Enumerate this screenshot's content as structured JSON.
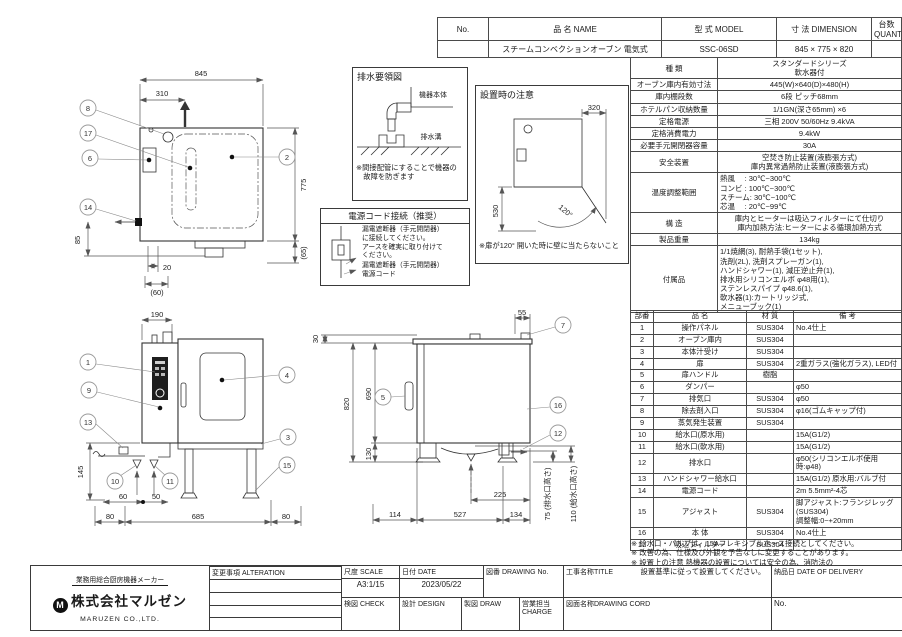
{
  "header_table": {
    "cols": {
      "no": "No.",
      "name": "品  名  NAME",
      "model": "型  式  MODEL",
      "dimension": "寸  法  DIMENSION",
      "quantity": "台数 QUANTITY"
    },
    "row": {
      "no": "",
      "name": "スチームコンベクションオーブン 電気式",
      "model": "SSC-06SD",
      "dimension": "845 × 775 × 820",
      "quantity": ""
    }
  },
  "spec_table": {
    "rows": [
      {
        "label": "種  類",
        "value": "スタンダードシリーズ\n軟水器付"
      },
      {
        "label": "オーブン庫内有効寸法",
        "value": "445(W)×640(D)×480(H)"
      },
      {
        "label": "庫内棚段数",
        "value": "6段 ピッチ68mm"
      },
      {
        "label": "ホテルパン収納数量",
        "value": "1/1GN(深さ65mm) ×6"
      },
      {
        "label": "定格電源",
        "value": "三相 200V 50/60Hz 9.4kVA"
      },
      {
        "label": "定格消費電力",
        "value": "9.4kW"
      },
      {
        "label": "必要手元開閉器容量",
        "value": "30A"
      },
      {
        "label": "安全装置",
        "value": "空焚き防止装置(液膨張方式)\n庫内異常過熱防止装置(液膨張方式)"
      },
      {
        "label": "温度調整範囲",
        "value": "熱風　 : 30℃~300℃\nコンビ : 100℃~300℃\nスチーム: 30℃~100℃\n芯温　 : 20℃~99℃"
      },
      {
        "label": "構  造",
        "value": "庫内とヒーターは吸込フィルターにて仕切り\n庫内加熱方法:ヒーターによる循環加熱方式"
      },
      {
        "label": "製品重量",
        "value": "134kg"
      },
      {
        "label": "付属品",
        "value": "1/1焼網(3), 耐熱手袋(1セット),\n洗剤(2L), 洗剤スプレーガン(1),\nハンドシャワー(1), 減圧逆止弁(1),\n排水用シリコンエルボ φ48用(1),\nステンレスパイプ φ48.6(1),\n軟水器(1):カートリッジ式,\nメニューブック(1)"
      }
    ]
  },
  "parts_table": {
    "headers": {
      "no": "部番",
      "name": "品  名",
      "material": "材  質",
      "remarks": "備  考"
    },
    "rows": [
      {
        "no": "1",
        "name": "操作パネル",
        "material": "SUS304",
        "remarks": "No.4仕上"
      },
      {
        "no": "2",
        "name": "オーブン庫内",
        "material": "SUS304",
        "remarks": ""
      },
      {
        "no": "3",
        "name": "本体汁受け",
        "material": "SUS304",
        "remarks": ""
      },
      {
        "no": "4",
        "name": "扉",
        "material": "SUS304",
        "remarks": "2重ガラス(強化ガラス), LED付"
      },
      {
        "no": "5",
        "name": "扉ハンドル",
        "material": "樹脂",
        "remarks": ""
      },
      {
        "no": "6",
        "name": "ダンパー",
        "material": "",
        "remarks": "φ50"
      },
      {
        "no": "7",
        "name": "排気口",
        "material": "SUS304",
        "remarks": "φ50"
      },
      {
        "no": "8",
        "name": "除去剤入口",
        "material": "SUS304",
        "remarks": "φ16(ゴムキャップ付)"
      },
      {
        "no": "9",
        "name": "蒸気発生装置",
        "material": "SUS304",
        "remarks": ""
      },
      {
        "no": "10",
        "name": "給水口(原水用)",
        "material": "",
        "remarks": "15A(G1/2)"
      },
      {
        "no": "11",
        "name": "給水口(軟水用)",
        "material": "",
        "remarks": "15A(G1/2)"
      },
      {
        "no": "12",
        "name": "排水口",
        "material": "",
        "remarks": "φ50(シリコンエルボ使用時:φ48)"
      },
      {
        "no": "13",
        "name": "ハンドシャワー給水口",
        "material": "",
        "remarks": "15A(G1/2) 原水用:バルブ付"
      },
      {
        "no": "14",
        "name": "電源コード",
        "material": "",
        "remarks": "2m 5.5mm²-4芯"
      },
      {
        "no": "15",
        "name": "アジャスト",
        "material": "SUS304",
        "remarks": "脚アジャスト:フランジレッグ(SUS304)\n調整幅:0~+20mm"
      },
      {
        "no": "16",
        "name": "本  体",
        "material": "SUS304",
        "remarks": "No.4仕上"
      },
      {
        "no": "17",
        "name": "吸込フィルター",
        "material": "SUS304",
        "remarks": ""
      }
    ]
  },
  "notes": "※ 給水口・バルブは、15Aフレキシブルホース接続としてください。\n※ 改善の為、仕様及び外観を予告なしに変更することがあります。\n※ 設置上の注意 熱機器の設置については安全の為、消防法の\n　 設置基準に従って設置してください。",
  "title_block": {
    "maker_tagline": "業務用総合厨房機器メーカー",
    "company": "株式会社マルゼン",
    "company_en": "MARUZEN CO.,LTD.",
    "alteration_label": "変更事項 ALTERATION",
    "scale_label": "尺度 SCALE",
    "scale_value": "A3:1/15",
    "date_label": "日付 DATE",
    "date_value": "2023/05/22",
    "check_label": "検図 CHECK",
    "design_label": "設計 DESIGN",
    "draw_label": "製図 DRAW",
    "drawing_no_label": "図番 DRAWING No.",
    "charge_label": "営業担当CHARGE",
    "title_label": "工事名称TITLE",
    "drawing_name_label": "図面名称DRAWING CORD",
    "delivery_label": "納品日 DATE OF DELIVERY",
    "no_label": "No."
  },
  "boxes": {
    "drain": {
      "title": "排水要領図",
      "body_label": "機器本体",
      "ditch_label": "排水溝",
      "note": "※間接配管にすることで機器の\n　故障を防ぎます"
    },
    "install": {
      "title": "設置時の注意",
      "dim_320": "320",
      "dim_530": "530",
      "angle": "120°",
      "note": "※扉が120° 開いた時に壁に当たらないこと"
    },
    "power": {
      "title": "電源コード接続（推奨）",
      "instruction": "漏電遮断器（手元開閉器）\nに接続してください。\nアースを確実に取り付けて\nください。",
      "breaker_label": "漏電遮断器（手元開閉器）",
      "cord_label": "電源コード"
    }
  },
  "views": {
    "top": {
      "dim_845": "845",
      "dim_310": "310",
      "dim_775": "775",
      "dim_65": "(65)",
      "dim_85": "85",
      "dim_20": "20",
      "dim_60": "(60)",
      "balloons": {
        "b8": "8",
        "b17": "17",
        "b6": "6",
        "b14": "14",
        "b2": "2"
      }
    },
    "front": {
      "dim_190": "190",
      "dim_145": "145",
      "dim_60": "60",
      "dim_50": "50",
      "dim_80l": "80",
      "dim_685": "685",
      "dim_80r": "80",
      "balloons": {
        "b1": "1",
        "b9": "9",
        "b13": "13",
        "b10": "10",
        "b11": "11",
        "b4": "4",
        "b3": "3",
        "b15": "15"
      }
    },
    "side": {
      "dim_30": "30",
      "dim_55": "55",
      "dim_820": "820",
      "dim_690": "690",
      "dim_130": "130",
      "dim_225": "225",
      "dim_114": "114",
      "dim_527": "527",
      "dim_134": "134",
      "dim_75": "75 (排水口高さ)",
      "dim_110": "110 (給水口高さ)",
      "balloons": {
        "b7": "7",
        "b5": "5",
        "b16": "16",
        "b12": "12"
      }
    }
  }
}
